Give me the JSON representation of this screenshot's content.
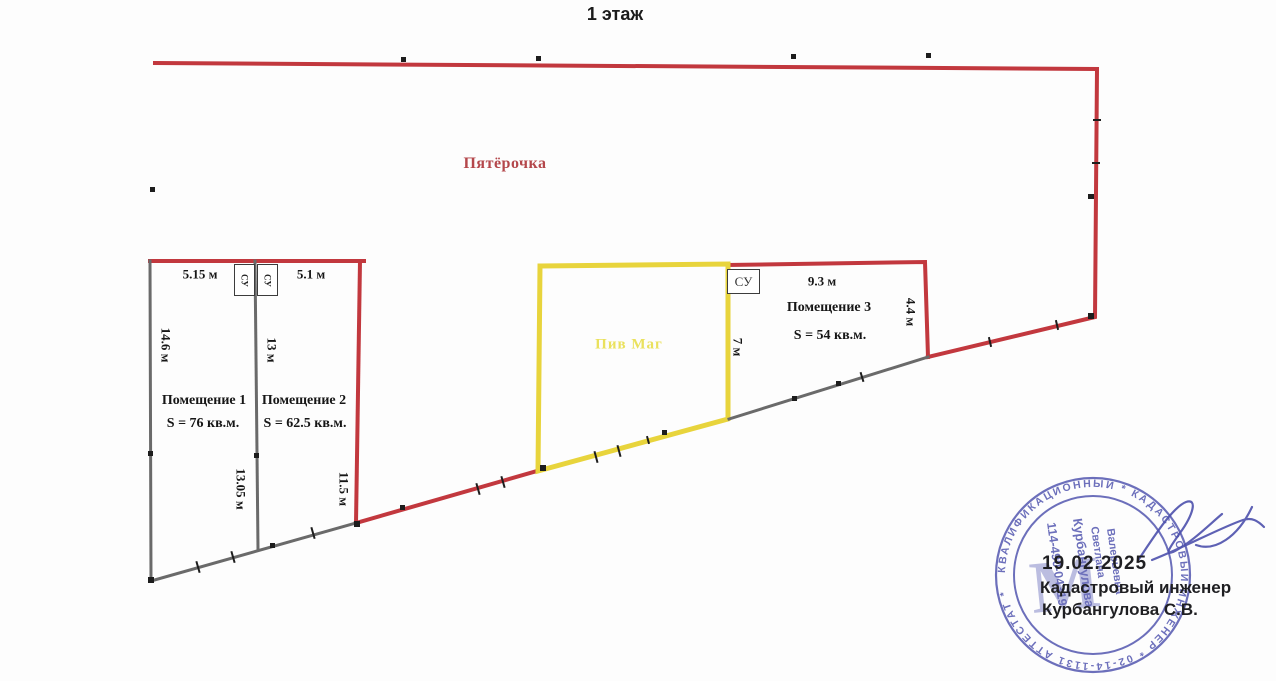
{
  "title": "1 этаж",
  "plan": {
    "store_label": "Пятёрочка",
    "beer_label": "Пив Маг",
    "su_label": "СУ",
    "rooms": [
      {
        "name": "Помещение 1",
        "area": "S = 76 кв.м."
      },
      {
        "name": "Помещение 2",
        "area": "S = 62.5 кв.м."
      },
      {
        "name": "Помещение 3",
        "area": "S = 54 кв.м."
      }
    ],
    "dims": {
      "top_room1": "5.15 м",
      "top_room2": "5.1 м",
      "left_wall": "14.6 м",
      "mid_wall_upper": "13 м",
      "mid_wall_lower": "13.05 м",
      "room2_right_wall": "11.5 м",
      "room3_top": "9.3 м",
      "room3_right": "4.4 м",
      "room3_left": "7 м"
    }
  },
  "stamp": {
    "date": "19.02.2025",
    "caption_line1": "Кадастровый инженер",
    "caption_line2": "Курбангулова С.В.",
    "ring_text": "КВАЛИФИКАЦИОННЫЙ  *  КАДАСТРОВЫЙ ИНЖЕНЕР  *  02-14-1131 АТТЕСТАТ  *",
    "inner_number": "114-490-04319",
    "inner_name1": "Курбангулова",
    "inner_name2": "Светлана",
    "inner_name3": "Валерьевна",
    "monogram": "М"
  },
  "colors": {
    "outline_red": "#c2383e",
    "outline_yellow": "#e8d43c",
    "wall_gray": "#6a6a6a",
    "stamp_blue": "#4d51ad",
    "store_text": "#b4474b",
    "beer_text": "#e9e055"
  }
}
